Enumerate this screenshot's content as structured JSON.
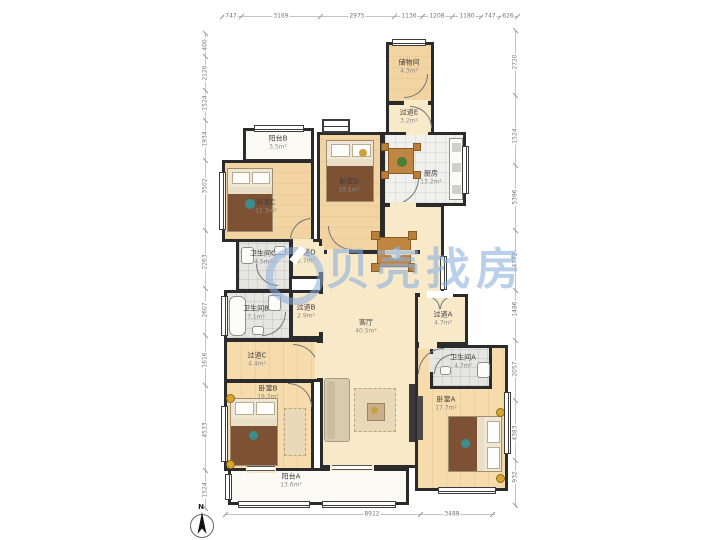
{
  "watermark": {
    "brand": "贝壳找房"
  },
  "compass": {
    "north_label": "N"
  },
  "dimensions": {
    "top": [
      "747",
      "3169",
      "2975",
      "1136",
      "1208",
      "1180",
      "747",
      "626"
    ],
    "left": [
      "400",
      "2120",
      "1524",
      "1934",
      "3502",
      "2263",
      "2607",
      "1616",
      "4533",
      "1524"
    ],
    "right": [
      "2720",
      "1524",
      "5396",
      "4772",
      "1486",
      "2057",
      "4383",
      "932"
    ],
    "bottom": [
      "8912",
      "3488"
    ]
  },
  "rooms": {
    "storage": {
      "name": "储物间",
      "area": "4.3m²"
    },
    "hallway_e": {
      "name": "过道E",
      "area": "3.2m²"
    },
    "balcony_b": {
      "name": "阳台B",
      "area": "3.5m²"
    },
    "bedroom_c": {
      "name": "卧室C",
      "area": "11.3m²"
    },
    "bedroom_d": {
      "name": "卧室D",
      "area": "10.1m²"
    },
    "kitchen": {
      "name": "厨房",
      "area": "13.2m²"
    },
    "bath_c": {
      "name": "卫生间C",
      "area": "4.5m²"
    },
    "hallway_d": {
      "name": "过道D",
      "area": "2.7m²"
    },
    "bath_b": {
      "name": "卫生间B",
      "area": "7.1m²"
    },
    "hallway_b": {
      "name": "过道B",
      "area": "2.9m²"
    },
    "hallway_c": {
      "name": "过道C",
      "area": "4.4m²"
    },
    "living": {
      "name": "客厅",
      "area": "40.5m²"
    },
    "hallway_a": {
      "name": "过道A",
      "area": "4.7m²"
    },
    "bath_a": {
      "name": "卫生间A",
      "area": "4.7m²"
    },
    "bedroom_b": {
      "name": "卧室B",
      "area": "19.2m²"
    },
    "bedroom_a": {
      "name": "卧室A",
      "area": "17.7m²"
    },
    "balcony_a": {
      "name": "阳台A",
      "area": "13.6m²"
    }
  },
  "colors": {
    "wall": "#2b2b2b",
    "wood_floor": "#f2d3a2",
    "hall_floor": "#f8e9c9",
    "tile_floor": "#e5e5e2",
    "watermark_blue": "#8cafdc"
  }
}
